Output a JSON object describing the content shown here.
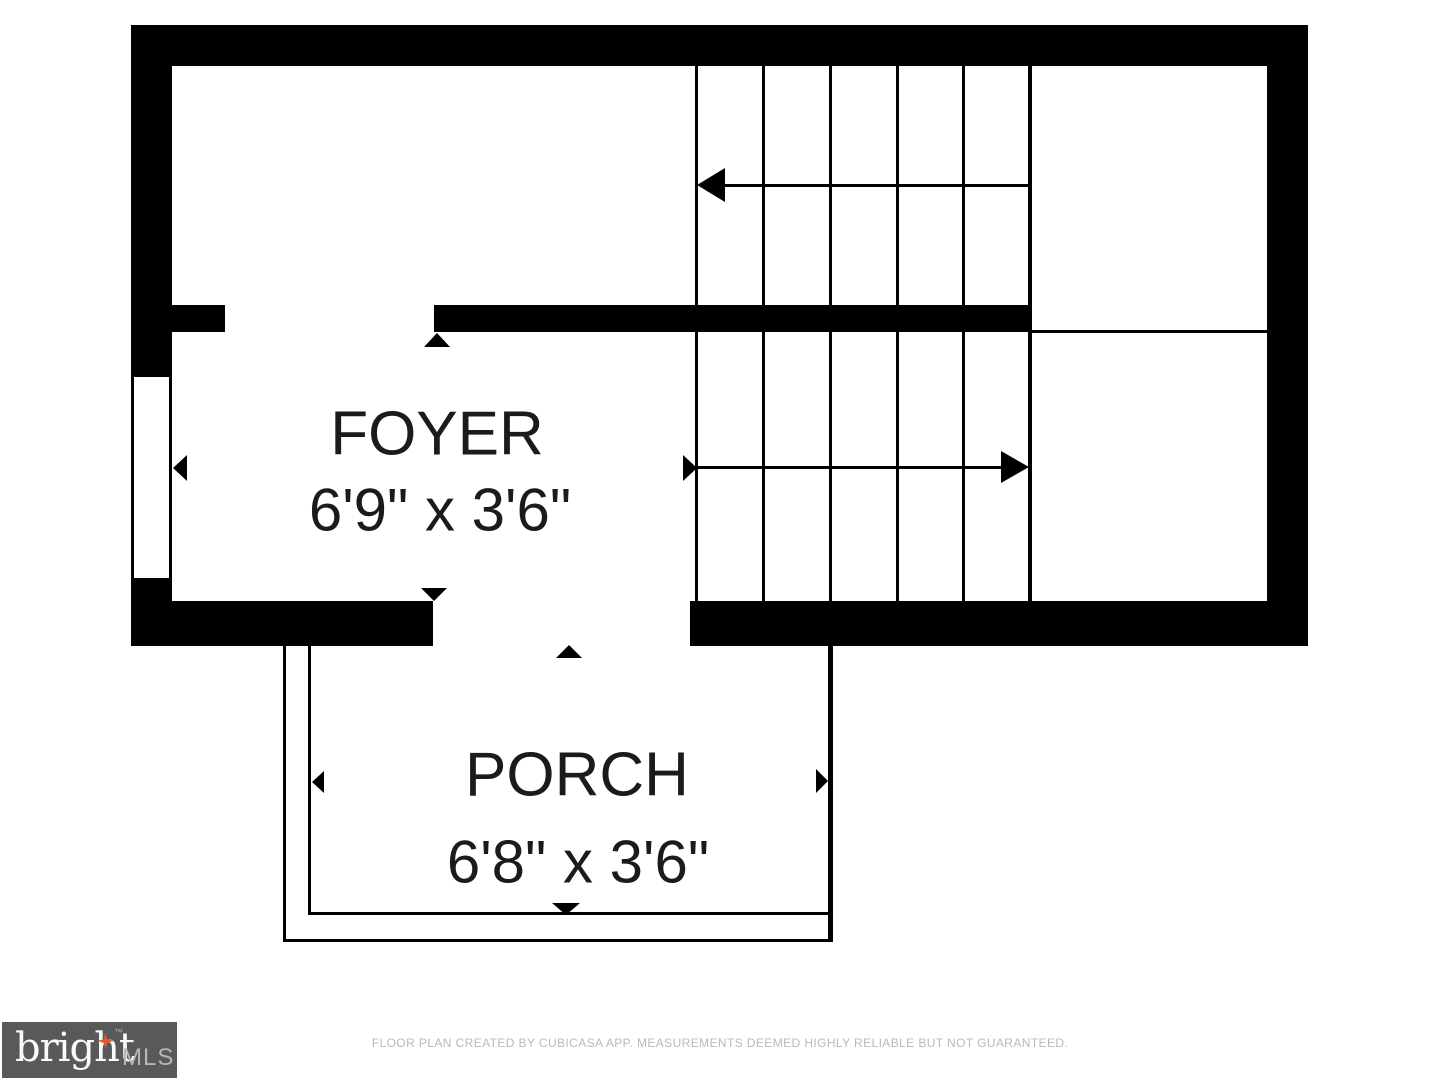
{
  "plan": {
    "rooms": [
      {
        "name": "FOYER",
        "dims": "6'9\" x 3'6\""
      },
      {
        "name": "PORCH",
        "dims": "6'8\" x 3'6\""
      }
    ],
    "stairs": {
      "treads_per_flight": 5,
      "upper_arrow_direction": "left",
      "lower_arrow_direction": "right"
    }
  },
  "footer": {
    "disclaimer": "FLOOR PLAN CREATED BY CUBICASA APP. MEASUREMENTS DEEMED HIGHLY RELIABLE BUT NOT GUARANTEED."
  },
  "logo": {
    "brand": "bright",
    "trademark": "™",
    "suffix": "MLS"
  },
  "colors": {
    "wall": "#000000",
    "background": "#ffffff",
    "logo_background": "#58595b",
    "logo_brand_text": "#fafafa",
    "logo_suffix_text": "#b5b6b8",
    "logo_star": "#e2592c",
    "disclaimer_text": "#b9b9b9"
  }
}
